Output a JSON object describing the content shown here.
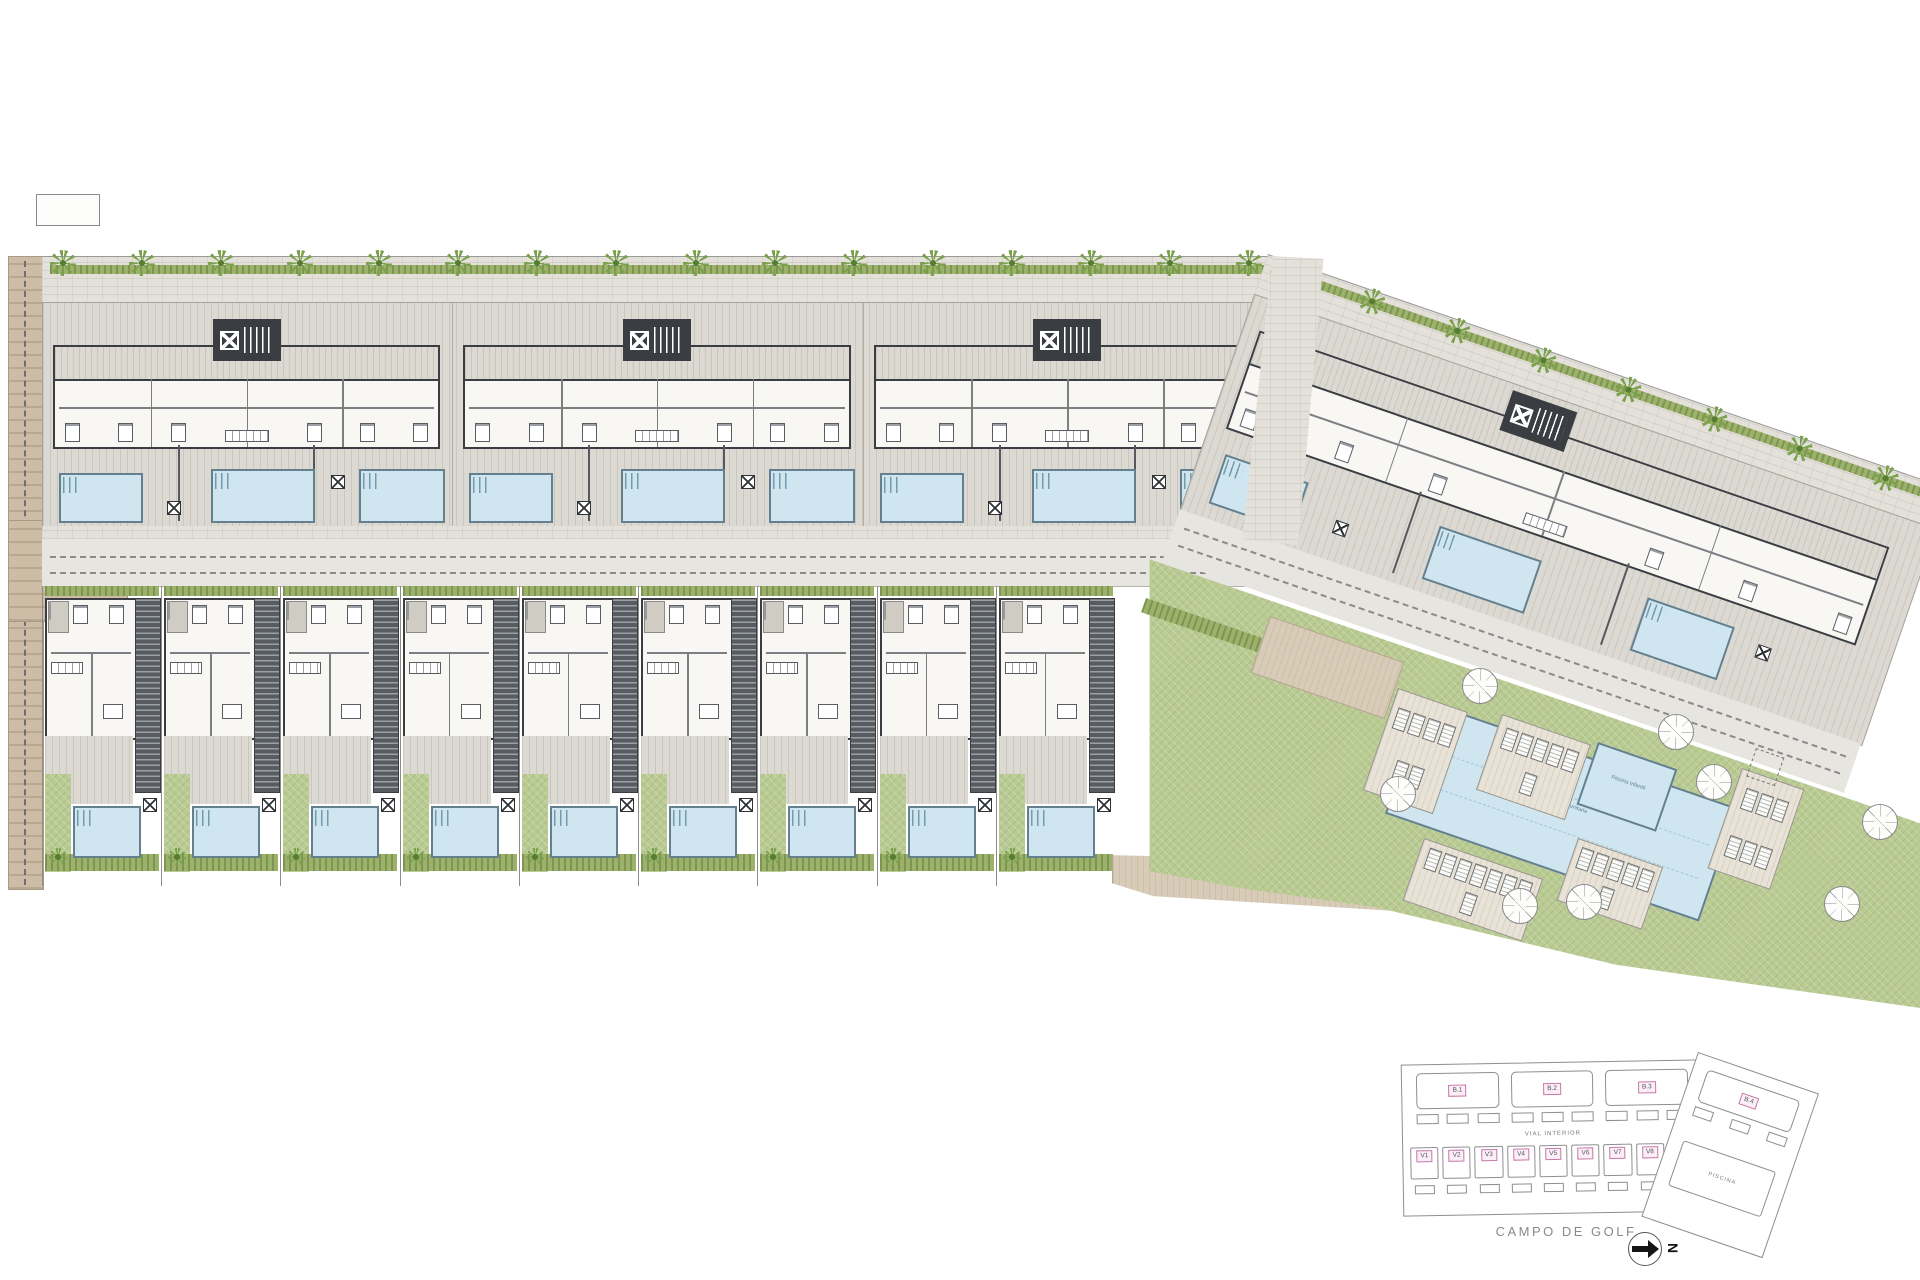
{
  "plan": {
    "keyplan": {
      "blocks": [
        "B.1",
        "B.2",
        "B.3",
        "B.4"
      ],
      "villas": [
        "V1",
        "V2",
        "V3",
        "V4",
        "V5",
        "V6",
        "V7",
        "V8",
        "V9"
      ],
      "road_label": "VIAL INTERIOR",
      "pool_building_label": "PISCINA",
      "golf_course_label": "CAMPO DE GOLF",
      "north_label": "N"
    },
    "amenities": {
      "main_pool_label": "Piscina Comunitaria",
      "kids_pool_label": "Piscina Infantil"
    },
    "colors": {
      "pool_blue": "#cfe6f1",
      "lawn_green": "#b9cb92",
      "hedge_green": "#9cb169",
      "terrace_grey": "#dcd9d2",
      "wall_dark": "#3a3e43",
      "path_tan": "#cdbda6",
      "label_pink": "#c878aa"
    }
  }
}
